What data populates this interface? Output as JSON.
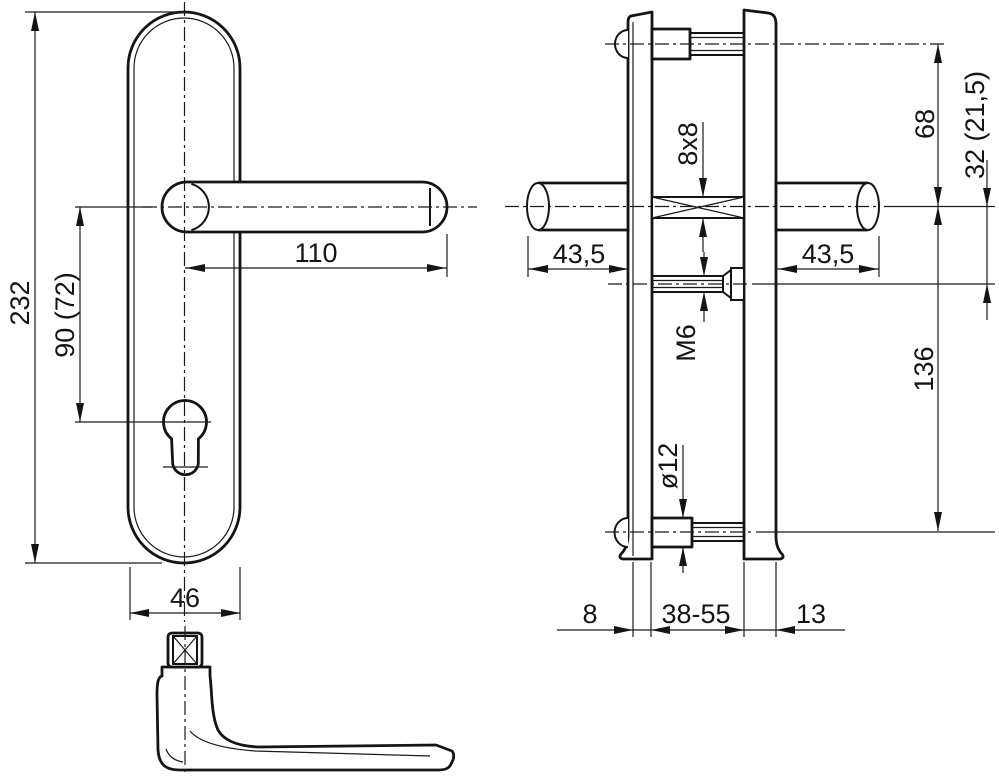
{
  "labels": {
    "front": {
      "plate_height": "232",
      "handle_to_cylinder": "90 (72)",
      "lever_length": "110",
      "plate_width": "46"
    },
    "side": {
      "top_fixing_to_axis": "68",
      "axis_to_screw": "32 (21,5)",
      "neck_left": "43,5",
      "neck_right": "43,5",
      "spindle_size": "8x8",
      "screw_size": "M6",
      "axis_to_bottom_fixing": "136",
      "fixing_head_dia": "ø12",
      "plate_thickness": "8",
      "door_thickness_range": "38-55",
      "cover_thickness": "13"
    }
  }
}
